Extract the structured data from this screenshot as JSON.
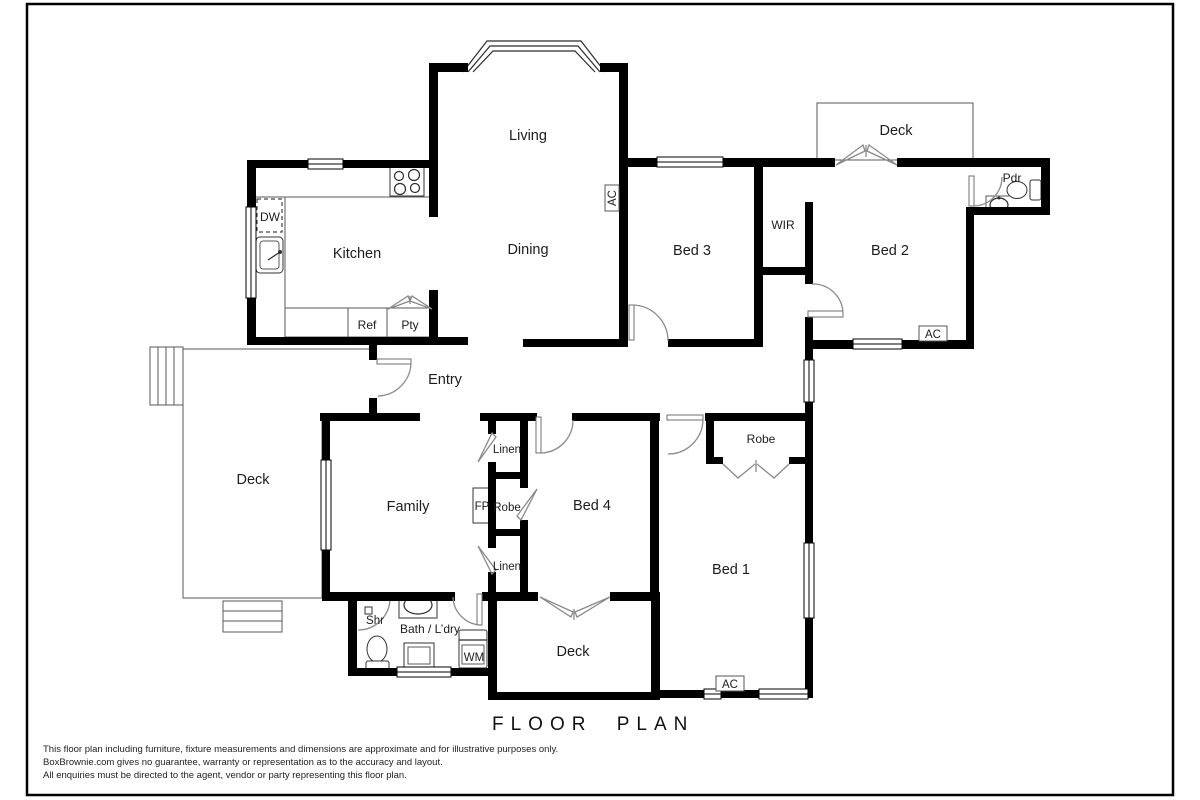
{
  "colors": {
    "wall": "#000000",
    "background": "#ffffff",
    "thin_line": "#5a5a5a",
    "door_arc": "#8a8a8a",
    "text": "#1c1c1c"
  },
  "rooms": {
    "living": {
      "label": "Living"
    },
    "dining": {
      "label": "Dining"
    },
    "kitchen": {
      "label": "Kitchen"
    },
    "entry": {
      "label": "Entry"
    },
    "family": {
      "label": "Family"
    },
    "bed1": {
      "label": "Bed 1"
    },
    "bed2": {
      "label": "Bed 2"
    },
    "bed3": {
      "label": "Bed 3"
    },
    "bed4": {
      "label": "Bed 4"
    },
    "wir": {
      "label": "WIR"
    },
    "pdr": {
      "label": "Pdr"
    },
    "bath": {
      "label": "Bath / L’dry"
    },
    "deck_top": {
      "label": "Deck"
    },
    "deck_left": {
      "label": "Deck"
    },
    "deck_bottom": {
      "label": "Deck"
    }
  },
  "closets": {
    "linen_top": "Linen",
    "robe_hall": "Robe",
    "linen_bottom": "Linen",
    "robe_bed1": "Robe"
  },
  "fixtures": {
    "dw": "DW",
    "ref": "Ref",
    "pty": "Pty",
    "fp": "FP",
    "shr": "Shr",
    "wm": "WM"
  },
  "hvac": {
    "ac": "AC"
  },
  "title": "FLOOR PLAN",
  "disclaimer": {
    "line1": "This floor plan including furniture, fixture measurements and dimensions are approximate and for illustrative purposes only.",
    "line2": "BoxBrownie.com gives no guarantee, warranty or representation as to the accuracy and layout.",
    "line3": "All enquiries must be directed to the agent, vendor or party representing this floor plan."
  }
}
